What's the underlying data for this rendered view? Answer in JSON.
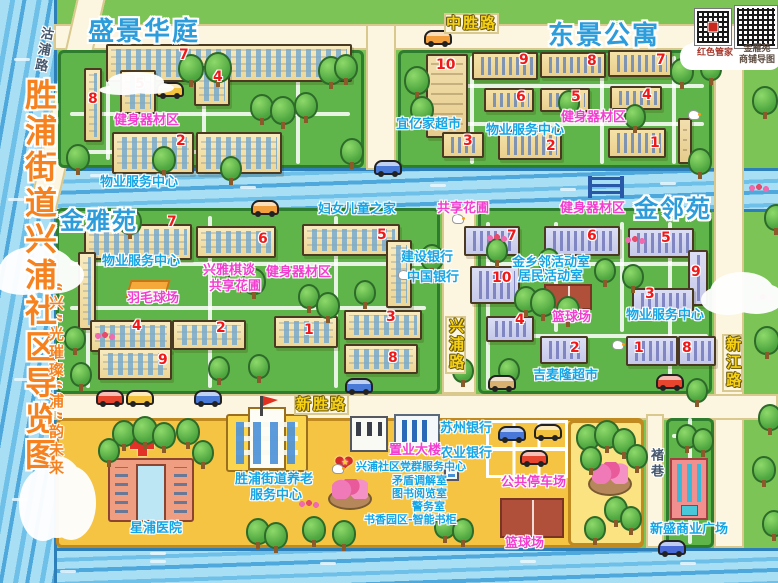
{
  "title": {
    "main": "胜浦街道兴浦社区导览图",
    "slogan": "“兴”光璀璨“浦”韵未来"
  },
  "qr_panel": {
    "qr1_label": "红色管家",
    "qr2_line1": "金雁苑",
    "qr2_line2": "商铺导图"
  },
  "map_labels": [
    {
      "id": "zone-title-shengjinghuating",
      "text": "盛景华庭",
      "kind": "title",
      "x": 88,
      "y": 18
    },
    {
      "id": "zone-title-dongjinggongyu",
      "text": "东景公寓",
      "kind": "title",
      "x": 548,
      "y": 22
    },
    {
      "id": "zone-title-jinyayuan",
      "text": "金雅苑",
      "kind": "title",
      "x": 60,
      "y": 208,
      "size": 24
    },
    {
      "id": "zone-title-jinlinyuan",
      "text": "金邻苑",
      "kind": "title",
      "x": 634,
      "y": 196,
      "size": 24
    },
    {
      "id": "road-label-zhongshenglu",
      "text": "中胜路",
      "kind": "road",
      "x": 444,
      "y": 13
    },
    {
      "id": "road-label-xinshenglu",
      "text": "新胜路",
      "kind": "road",
      "x": 294,
      "y": 394
    },
    {
      "id": "road-label-xingpulu",
      "text": "兴浦路",
      "kind": "road",
      "x": 445,
      "y": 316,
      "vert": true
    },
    {
      "id": "road-label-xinjianglu",
      "text": "新江路",
      "kind": "road",
      "x": 722,
      "y": 334,
      "vert": true
    },
    {
      "id": "road-label-gupulu",
      "text": "沽浦路",
      "kind": "road-dark",
      "x": 34,
      "y": 26,
      "vert": true,
      "rot": 10
    },
    {
      "id": "road-label-zhuxiang",
      "text": "褚巷",
      "kind": "road-dark",
      "x": 647,
      "y": 448,
      "vert": true
    },
    {
      "id": "label-wuye-shengjing",
      "text": "物业服务中心",
      "kind": "blue",
      "x": 100,
      "y": 176
    },
    {
      "id": "label-yiyijia-market",
      "text": "宜亿家超市",
      "kind": "blue",
      "x": 396,
      "y": 118
    },
    {
      "id": "label-wuye-dongjing",
      "text": "物业服务中心",
      "kind": "blue",
      "x": 486,
      "y": 124
    },
    {
      "id": "label-wuye-jinya",
      "text": "物业服务中心",
      "kind": "blue",
      "x": 102,
      "y": 255
    },
    {
      "id": "label-funv-ertong",
      "text": "妇女儿童之家",
      "kind": "blue",
      "x": 318,
      "y": 203
    },
    {
      "id": "label-jianshe-bank",
      "text": "建设银行",
      "kind": "blue",
      "x": 401,
      "y": 251
    },
    {
      "id": "label-zhongguo-bank",
      "text": "中国银行",
      "kind": "blue",
      "x": 407,
      "y": 271
    },
    {
      "id": "label-jinxianglin-room",
      "text": "金乡邻活动室",
      "kind": "blue",
      "x": 512,
      "y": 256
    },
    {
      "id": "label-jumin-room",
      "text": "居民活动室",
      "kind": "blue",
      "x": 518,
      "y": 270
    },
    {
      "id": "label-wuye-jinlin",
      "text": "物业服务中心",
      "kind": "blue",
      "x": 626,
      "y": 309
    },
    {
      "id": "label-jimailong-market",
      "text": "吉麦隆超市",
      "kind": "blue",
      "x": 533,
      "y": 369
    },
    {
      "id": "label-xingpu-hospital",
      "text": "星浦医院",
      "kind": "blue",
      "x": 130,
      "y": 522
    },
    {
      "id": "label-yanglao-line1",
      "text": "胜浦街道养老",
      "kind": "blue",
      "x": 235,
      "y": 473
    },
    {
      "id": "label-yanglao-line2",
      "text": "服务中心",
      "kind": "blue",
      "x": 250,
      "y": 489
    },
    {
      "id": "label-dangqun-center",
      "text": "兴浦社区党群服务中心",
      "kind": "blue",
      "x": 356,
      "y": 461,
      "size": 11
    },
    {
      "id": "label-maodun-room",
      "text": "矛盾调解室",
      "kind": "blue",
      "x": 392,
      "y": 475,
      "size": 11
    },
    {
      "id": "label-tushu-room",
      "text": "图书阅览室",
      "kind": "blue",
      "x": 392,
      "y": 488,
      "size": 11
    },
    {
      "id": "label-jingwu-room",
      "text": "警务室",
      "kind": "blue",
      "x": 412,
      "y": 501,
      "size": 11
    },
    {
      "id": "label-shuxiang-bookcase",
      "text": "书香园区-智能书柜",
      "kind": "blue",
      "x": 364,
      "y": 514,
      "size": 11
    },
    {
      "id": "label-suzhou-bank",
      "text": "苏州银行",
      "kind": "blue",
      "x": 440,
      "y": 422
    },
    {
      "id": "label-nongye-bank",
      "text": "农业银行",
      "kind": "blue",
      "x": 440,
      "y": 447
    },
    {
      "id": "label-xinsheng-plaza",
      "text": "新盛商业广场",
      "kind": "blue",
      "x": 650,
      "y": 523
    },
    {
      "id": "label-fitness-shengjing",
      "text": "健身器材区",
      "kind": "magenta",
      "x": 114,
      "y": 114
    },
    {
      "id": "label-fitness-dongjing",
      "text": "健身器材区",
      "kind": "magenta",
      "x": 561,
      "y": 111
    },
    {
      "id": "label-fitness-jinya",
      "text": "健身器材区",
      "kind": "magenta",
      "x": 266,
      "y": 266
    },
    {
      "id": "label-fitness-jinlin",
      "text": "健身器材区",
      "kind": "magenta",
      "x": 560,
      "y": 202
    },
    {
      "id": "label-xingya-chess",
      "text": "兴雅棋谈",
      "kind": "magenta",
      "x": 203,
      "y": 264
    },
    {
      "id": "label-shared-garden-jinya",
      "text": "共享花圃",
      "kind": "magenta",
      "x": 209,
      "y": 280
    },
    {
      "id": "label-shared-garden-jinlin",
      "text": "共享花圃",
      "kind": "magenta",
      "x": 437,
      "y": 202
    },
    {
      "id": "label-badminton",
      "text": "羽毛球场",
      "kind": "magenta",
      "x": 127,
      "y": 292
    },
    {
      "id": "label-basketball-jinlin",
      "text": "篮球场",
      "kind": "magenta",
      "x": 552,
      "y": 311
    },
    {
      "id": "label-basketball-south",
      "text": "篮球场",
      "kind": "magenta",
      "x": 505,
      "y": 537
    },
    {
      "id": "label-parking",
      "text": "公共停车场",
      "kind": "magenta",
      "x": 501,
      "y": 476
    },
    {
      "id": "label-zhiye-tower",
      "text": "置业大楼",
      "kind": "magenta",
      "x": 389,
      "y": 444
    }
  ],
  "building_numbers": [
    {
      "n": "7",
      "x": 179,
      "y": 48
    },
    {
      "n": "5",
      "x": 135,
      "y": 77
    },
    {
      "n": "4",
      "x": 213,
      "y": 70
    },
    {
      "n": "8",
      "x": 88,
      "y": 92
    },
    {
      "n": "2",
      "x": 176,
      "y": 134
    },
    {
      "n": "10",
      "x": 436,
      "y": 58
    },
    {
      "n": "9",
      "x": 519,
      "y": 53
    },
    {
      "n": "8",
      "x": 587,
      "y": 54
    },
    {
      "n": "7",
      "x": 656,
      "y": 53
    },
    {
      "n": "6",
      "x": 516,
      "y": 90
    },
    {
      "n": "5",
      "x": 571,
      "y": 90
    },
    {
      "n": "4",
      "x": 642,
      "y": 88
    },
    {
      "n": "3",
      "x": 463,
      "y": 134
    },
    {
      "n": "2",
      "x": 546,
      "y": 139
    },
    {
      "n": "1",
      "x": 650,
      "y": 136
    },
    {
      "n": "7",
      "x": 167,
      "y": 215
    },
    {
      "n": "6",
      "x": 258,
      "y": 232
    },
    {
      "n": "5",
      "x": 377,
      "y": 228
    },
    {
      "n": "4",
      "x": 132,
      "y": 319
    },
    {
      "n": "2",
      "x": 216,
      "y": 321
    },
    {
      "n": "9",
      "x": 158,
      "y": 353
    },
    {
      "n": "1",
      "x": 304,
      "y": 323
    },
    {
      "n": "3",
      "x": 386,
      "y": 310
    },
    {
      "n": "8",
      "x": 388,
      "y": 351
    },
    {
      "n": "7",
      "x": 507,
      "y": 229
    },
    {
      "n": "6",
      "x": 587,
      "y": 229
    },
    {
      "n": "5",
      "x": 661,
      "y": 231
    },
    {
      "n": "10",
      "x": 492,
      "y": 271
    },
    {
      "n": "9",
      "x": 691,
      "y": 265
    },
    {
      "n": "3",
      "x": 645,
      "y": 287
    },
    {
      "n": "4",
      "x": 515,
      "y": 313
    },
    {
      "n": "2",
      "x": 570,
      "y": 341
    },
    {
      "n": "1",
      "x": 634,
      "y": 341
    },
    {
      "n": "8",
      "x": 682,
      "y": 341
    }
  ],
  "buildings": [
    {
      "x": 106,
      "y": 44,
      "w": 246,
      "h": 38,
      "style": "g"
    },
    {
      "x": 120,
      "y": 70,
      "w": 36,
      "h": 44,
      "style": "g"
    },
    {
      "x": 194,
      "y": 66,
      "w": 36,
      "h": 40,
      "style": "g"
    },
    {
      "x": 84,
      "y": 68,
      "w": 18,
      "h": 74,
      "style": "g"
    },
    {
      "x": 112,
      "y": 132,
      "w": 82,
      "h": 42,
      "style": "g"
    },
    {
      "x": 196,
      "y": 132,
      "w": 86,
      "h": 42,
      "style": "g"
    },
    {
      "x": 426,
      "y": 54,
      "w": 42,
      "h": 84,
      "style": "t"
    },
    {
      "x": 472,
      "y": 52,
      "w": 66,
      "h": 28,
      "style": "s"
    },
    {
      "x": 540,
      "y": 52,
      "w": 66,
      "h": 26,
      "style": "s"
    },
    {
      "x": 608,
      "y": 50,
      "w": 64,
      "h": 27,
      "style": "s"
    },
    {
      "x": 484,
      "y": 88,
      "w": 50,
      "h": 24,
      "style": "s"
    },
    {
      "x": 540,
      "y": 88,
      "w": 50,
      "h": 24,
      "style": "s"
    },
    {
      "x": 610,
      "y": 86,
      "w": 52,
      "h": 24,
      "style": "s"
    },
    {
      "x": 442,
      "y": 132,
      "w": 42,
      "h": 26,
      "style": "s"
    },
    {
      "x": 498,
      "y": 130,
      "w": 64,
      "h": 30,
      "style": "s"
    },
    {
      "x": 608,
      "y": 128,
      "w": 58,
      "h": 30,
      "style": "s"
    },
    {
      "x": 678,
      "y": 118,
      "w": 14,
      "h": 46,
      "style": "t"
    },
    {
      "x": 84,
      "y": 224,
      "w": 108,
      "h": 36,
      "style": "g"
    },
    {
      "x": 78,
      "y": 252,
      "w": 18,
      "h": 78,
      "style": "g"
    },
    {
      "x": 196,
      "y": 226,
      "w": 80,
      "h": 32,
      "style": "g"
    },
    {
      "x": 302,
      "y": 224,
      "w": 98,
      "h": 32,
      "style": "g"
    },
    {
      "x": 386,
      "y": 240,
      "w": 26,
      "h": 68,
      "style": "g"
    },
    {
      "x": 90,
      "y": 320,
      "w": 82,
      "h": 32,
      "style": "g"
    },
    {
      "x": 172,
      "y": 320,
      "w": 74,
      "h": 30,
      "style": "g"
    },
    {
      "x": 98,
      "y": 348,
      "w": 74,
      "h": 32,
      "style": "g"
    },
    {
      "x": 274,
      "y": 316,
      "w": 64,
      "h": 32,
      "style": "g"
    },
    {
      "x": 344,
      "y": 310,
      "w": 78,
      "h": 30,
      "style": "g"
    },
    {
      "x": 344,
      "y": 344,
      "w": 74,
      "h": 30,
      "style": "g"
    },
    {
      "x": 464,
      "y": 226,
      "w": 56,
      "h": 30,
      "style": "p"
    },
    {
      "x": 544,
      "y": 226,
      "w": 76,
      "h": 30,
      "style": "p"
    },
    {
      "x": 628,
      "y": 228,
      "w": 66,
      "h": 30,
      "style": "p"
    },
    {
      "x": 470,
      "y": 266,
      "w": 50,
      "h": 38,
      "style": "p"
    },
    {
      "x": 688,
      "y": 250,
      "w": 20,
      "h": 56,
      "style": "p"
    },
    {
      "x": 632,
      "y": 288,
      "w": 62,
      "h": 26,
      "style": "p"
    },
    {
      "x": 486,
      "y": 316,
      "w": 48,
      "h": 26,
      "style": "p"
    },
    {
      "x": 540,
      "y": 336,
      "w": 48,
      "h": 28,
      "style": "p"
    },
    {
      "x": 626,
      "y": 336,
      "w": 52,
      "h": 30,
      "style": "p"
    },
    {
      "x": 678,
      "y": 336,
      "w": 38,
      "h": 30,
      "style": "p"
    }
  ]
}
